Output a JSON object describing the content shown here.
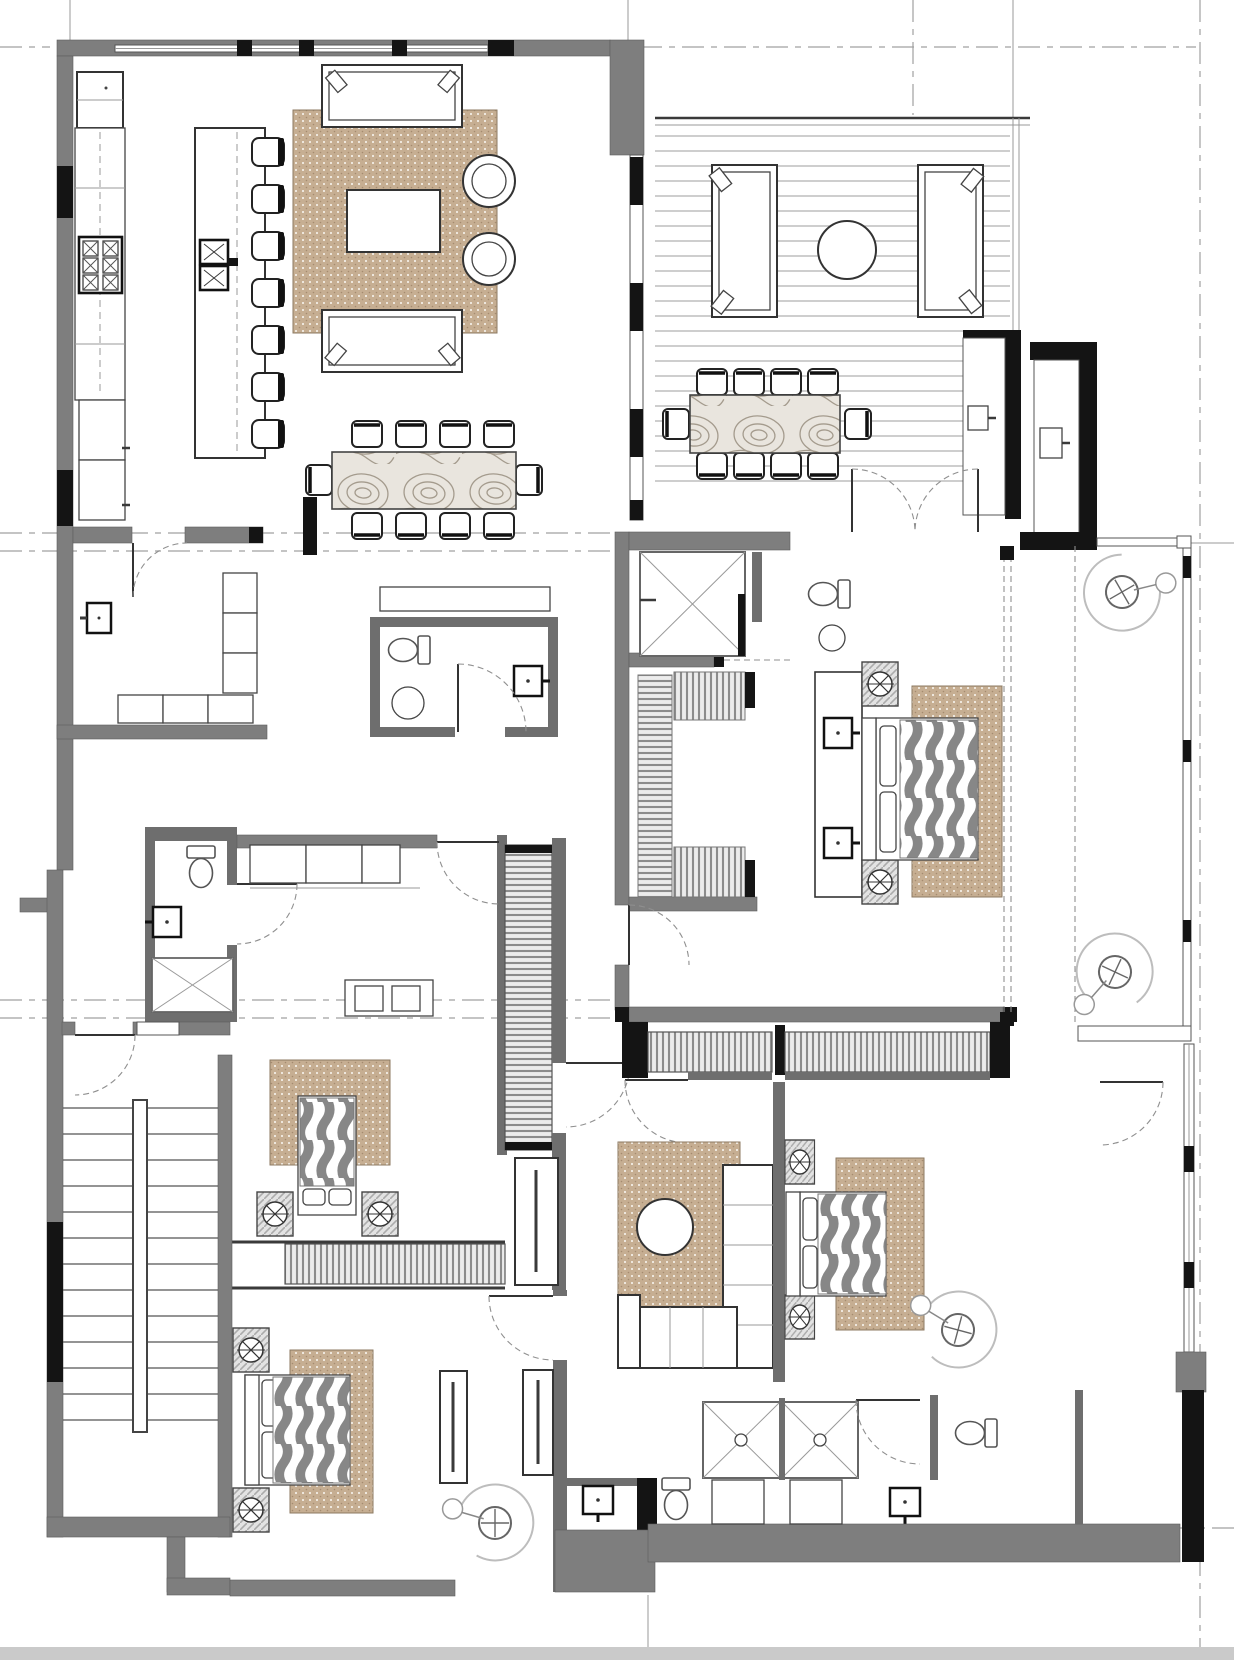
{
  "document": {
    "kind": "architectural-floor-plan",
    "view": "furnished top-down plan, single storey",
    "annotations": "no text labels or dimensions visible; graphics only"
  },
  "colors": {
    "background": "#ffffff",
    "wall_fill": "#7e7e7e",
    "wall_dark": "#141414",
    "line": "#3a3a3a",
    "line_light": "#999999",
    "rug": "#c6ae92",
    "rug_dot": "#ffffff",
    "quilt": "#878787",
    "deck_line": "#b0b0b0",
    "grain_line": "#a49b8d",
    "hang_line": "#8c8c8c",
    "grid": "#a0a0a0",
    "scan_band": "#cacaca"
  },
  "symbols": [
    {
      "icon": "wall-icon",
      "meaning": "gray poche = partition walls"
    },
    {
      "icon": "window-jamb-icon",
      "meaning": "black blocks = glazing jambs / columns"
    },
    {
      "icon": "rug-icon",
      "meaning": "tan dotted fill = area rug"
    },
    {
      "icon": "wavy-quilt-icon",
      "meaning": "gray wave fill = bed cover"
    },
    {
      "icon": "hanging-clothes-icon",
      "meaning": "striped band = wardrobe hanging rail"
    },
    {
      "icon": "shower-x-icon",
      "meaning": "crossed square = shower"
    },
    {
      "icon": "door-swing-icon",
      "meaning": "dashed quarter arc = door swing"
    },
    {
      "icon": "ceiling-light-icon",
      "meaning": "crossed circle on hatched square = bedside table with light"
    },
    {
      "icon": "lounge-chair-icon",
      "meaning": "swirl with crossed hub = swivel lounge chair"
    },
    {
      "icon": "deck-boards-icon",
      "meaning": "horizontal lines = timber deck"
    }
  ],
  "rooms": [
    {
      "name": "kitchen",
      "furniture": [
        {
          "item": "tall-cabinet-fridge",
          "count": 1
        },
        {
          "item": "counter-run",
          "count": 1
        },
        {
          "item": "range-6-burner",
          "count": 1
        },
        {
          "item": "base-cabinets",
          "count": 2
        },
        {
          "item": "island-with-cooktop",
          "count": 1
        },
        {
          "item": "bar-stool",
          "count": 7
        }
      ]
    },
    {
      "name": "living-room",
      "furniture": [
        {
          "item": "sofa",
          "count": 2
        },
        {
          "item": "coffee-table",
          "count": 1
        },
        {
          "item": "round-lounge-chair",
          "count": 2
        },
        {
          "item": "area-rug",
          "count": 1
        }
      ]
    },
    {
      "name": "dining-area",
      "furniture": [
        {
          "item": "wood-grain-dining-table",
          "count": 1
        },
        {
          "item": "dining-chair",
          "count": 10
        }
      ]
    },
    {
      "name": "covered-terrace",
      "furniture": [
        {
          "item": "outdoor-sofa",
          "count": 2
        },
        {
          "item": "round-outdoor-table",
          "count": 1
        },
        {
          "item": "outdoor-dining-table",
          "count": 1
        },
        {
          "item": "outdoor-dining-chair",
          "count": 10
        },
        {
          "item": "storage-cabinet",
          "count": 2
        },
        {
          "item": "deck-boards",
          "count": 1
        }
      ]
    },
    {
      "name": "entry-foyer",
      "furniture": [
        {
          "item": "coat-closet-shelving",
          "count": 1
        },
        {
          "item": "low-cabinet-row",
          "count": 1
        },
        {
          "item": "wall-panel",
          "count": 1
        }
      ]
    },
    {
      "name": "powder-room",
      "furniture": [
        {
          "item": "toilet",
          "count": 1
        },
        {
          "item": "round-basin",
          "count": 1
        },
        {
          "item": "wall-sink",
          "count": 1
        },
        {
          "item": "console",
          "count": 1
        }
      ]
    },
    {
      "name": "master-bathroom",
      "furniture": [
        {
          "item": "walk-in-shower",
          "count": 1
        },
        {
          "item": "toilet",
          "count": 1
        },
        {
          "item": "round-basin",
          "count": 1
        }
      ]
    },
    {
      "name": "master-walk-in-closet",
      "furniture": [
        {
          "item": "hanging-rail",
          "count": 3
        }
      ]
    },
    {
      "name": "master-bedroom",
      "furniture": [
        {
          "item": "double-vanity-sink",
          "count": 2
        },
        {
          "item": "king-bed-wavy-quilt",
          "count": 1
        },
        {
          "item": "nightstand-with-light",
          "count": 2
        },
        {
          "item": "area-rug",
          "count": 1
        }
      ]
    },
    {
      "name": "master-balcony",
      "furniture": [
        {
          "item": "lounge-chair",
          "count": 2
        }
      ]
    },
    {
      "name": "bathroom-2",
      "furniture": [
        {
          "item": "toilet",
          "count": 1
        },
        {
          "item": "wall-sink",
          "count": 1
        },
        {
          "item": "shower",
          "count": 1
        }
      ]
    },
    {
      "name": "bedroom-2",
      "furniture": [
        {
          "item": "bed-wavy-quilt",
          "count": 1
        },
        {
          "item": "nightstand-with-light",
          "count": 2
        },
        {
          "item": "area-rug",
          "count": 1
        },
        {
          "item": "built-in-cabinets",
          "count": 2
        },
        {
          "item": "hanging-closet",
          "count": 1
        },
        {
          "item": "wardrobe-strip",
          "count": 1
        }
      ]
    },
    {
      "name": "staircase",
      "furniture": [
        {
          "item": "straight-run-stair",
          "count": 1
        },
        {
          "item": "handrail",
          "count": 1
        }
      ]
    },
    {
      "name": "bedroom-3",
      "furniture": [
        {
          "item": "bed-wavy-quilt",
          "count": 1
        },
        {
          "item": "nightstand-with-light",
          "count": 2
        },
        {
          "item": "area-rug",
          "count": 1
        },
        {
          "item": "tall-wardrobe",
          "count": 2
        },
        {
          "item": "lounge-chair",
          "count": 1
        }
      ]
    },
    {
      "name": "hallway",
      "furniture": [
        {
          "item": "hanging-wardrobe",
          "count": 2
        },
        {
          "item": "tall-wardrobe",
          "count": 1
        }
      ]
    },
    {
      "name": "family-room",
      "furniture": [
        {
          "item": "sectional-sofa",
          "count": 1
        },
        {
          "item": "round-coffee-table",
          "count": 1
        },
        {
          "item": "area-rug",
          "count": 1
        }
      ]
    },
    {
      "name": "bedroom-4",
      "furniture": [
        {
          "item": "bed-wavy-quilt",
          "count": 1
        },
        {
          "item": "nightstand-with-light",
          "count": 2
        },
        {
          "item": "area-rug",
          "count": 1
        },
        {
          "item": "lounge-chair",
          "count": 1
        }
      ]
    },
    {
      "name": "bathroom-3",
      "furniture": [
        {
          "item": "shower",
          "count": 1
        },
        {
          "item": "toilet",
          "count": 1
        },
        {
          "item": "vanity",
          "count": 1
        }
      ]
    },
    {
      "name": "bathroom-4",
      "furniture": [
        {
          "item": "shower",
          "count": 1
        },
        {
          "item": "toilet",
          "count": 1
        },
        {
          "item": "vanity",
          "count": 1
        },
        {
          "item": "wall-sink",
          "count": 2
        }
      ]
    }
  ]
}
